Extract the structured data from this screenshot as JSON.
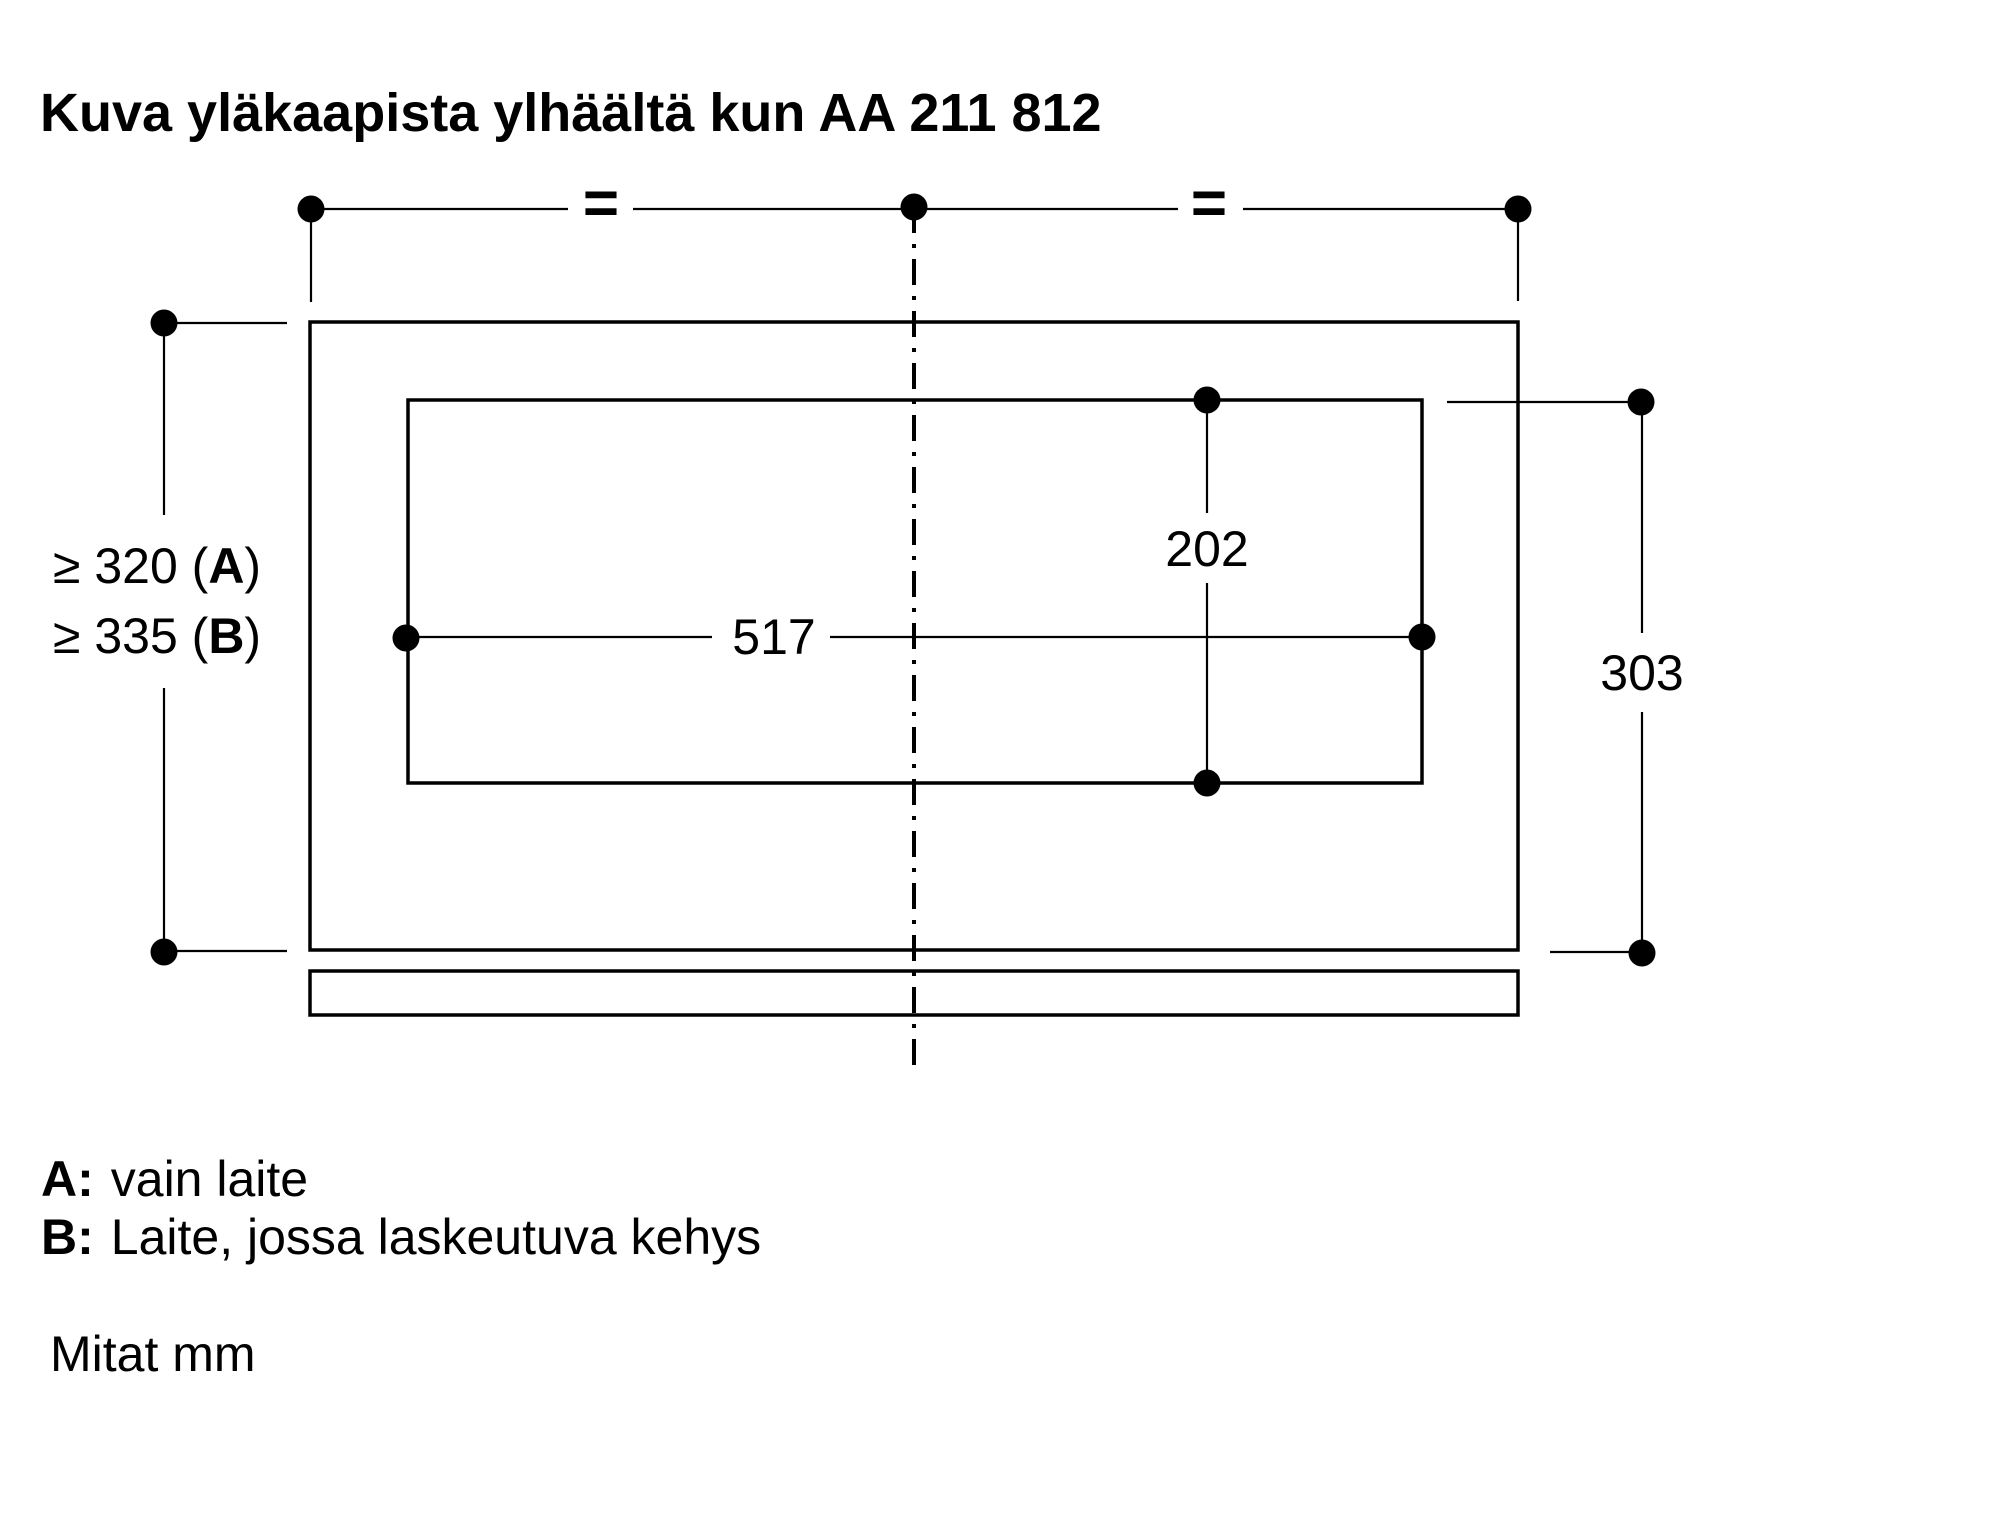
{
  "title": "Kuva yläkaapista ylhäältä kun AA 211 812",
  "dimension_labels": {
    "clearance_a": {
      "pre": "≥ 320 (",
      "bold": "A",
      "post": ")"
    },
    "clearance_b": {
      "pre": "≥ 335 (",
      "bold": "B",
      "post": ")"
    },
    "width": "517",
    "cutout_depth": "202",
    "right_depth": "303"
  },
  "symbols": {
    "equal": "="
  },
  "legend": [
    {
      "key": "A:",
      "text": "vain laite"
    },
    {
      "key": "B:",
      "text": "Laite, jossa laskeutuva kehys"
    }
  ],
  "units_note": "Mitat mm",
  "colors": {
    "ink": "#000000",
    "background": "#ffffff"
  }
}
